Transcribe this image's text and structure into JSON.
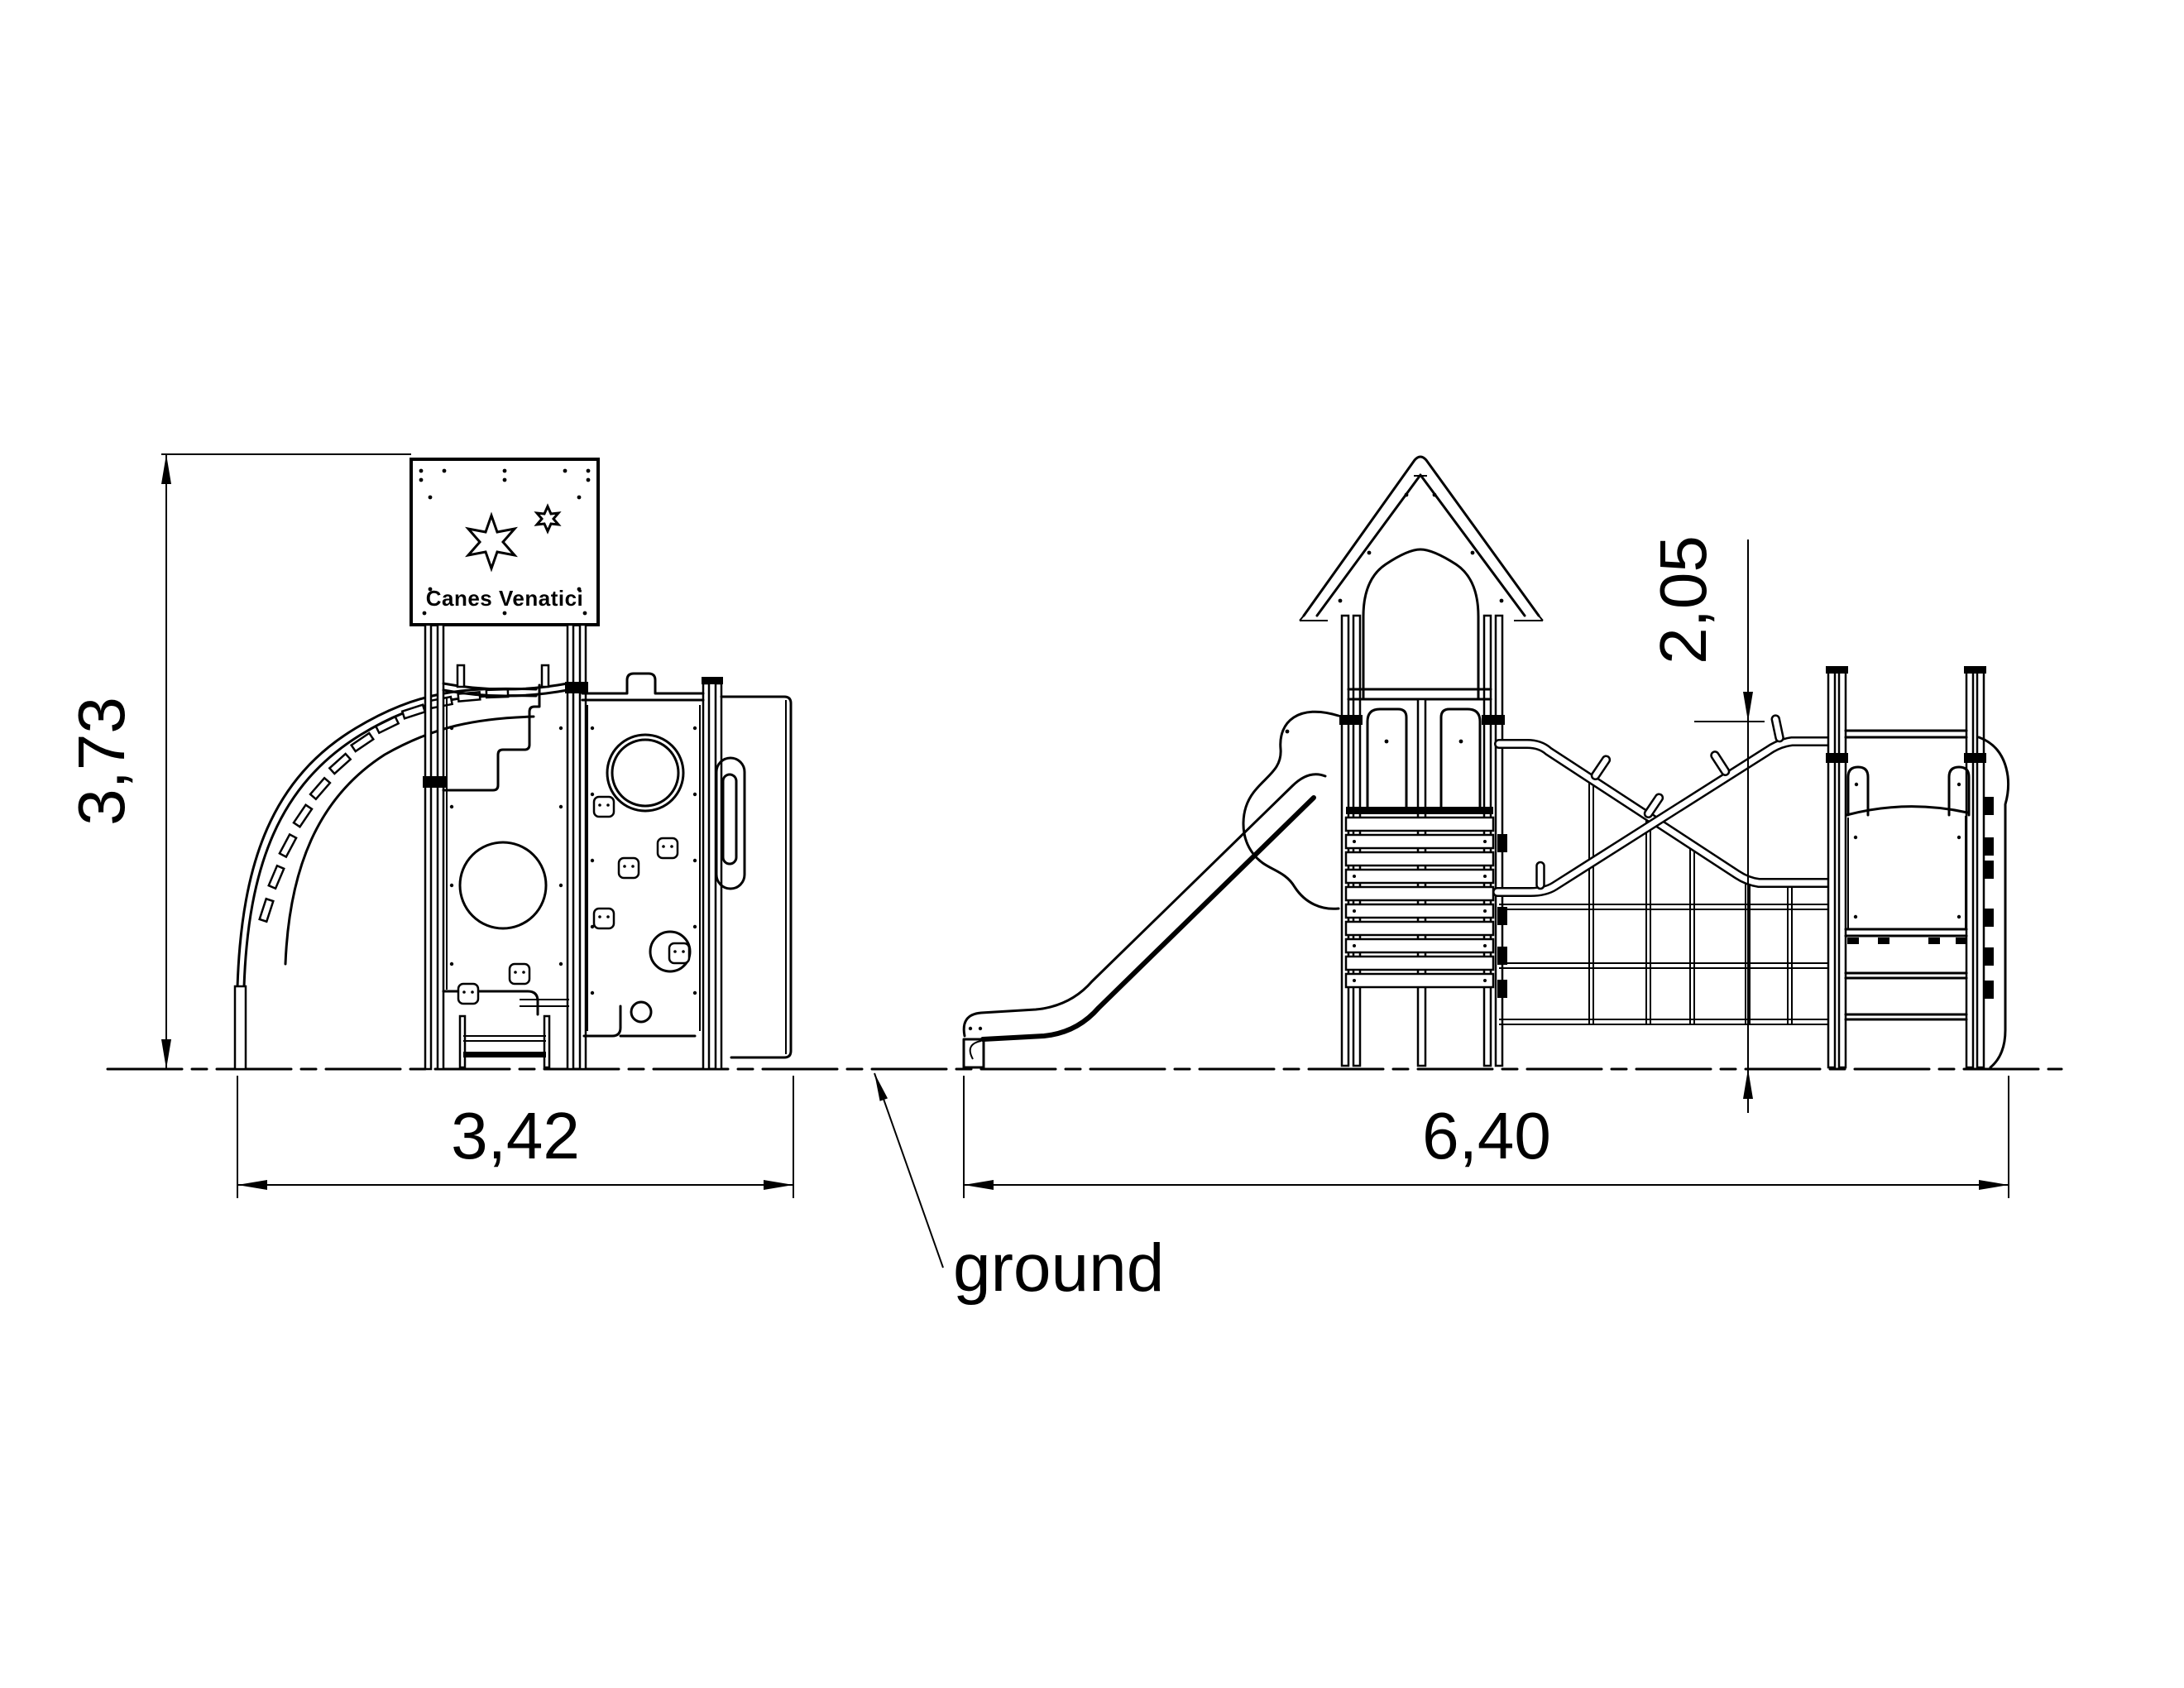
{
  "drawing": {
    "sign_label": "Canes Venatici",
    "sign_icons": [
      "six-pointed-star-large",
      "six-pointed-star-small"
    ],
    "ground_label": "ground",
    "dimensions": {
      "front_height": "3,73",
      "front_width": "3,42",
      "side_length": "6,40",
      "climb_height": "2,05"
    },
    "colors": {
      "line": "#000000",
      "background": "#ffffff"
    }
  }
}
